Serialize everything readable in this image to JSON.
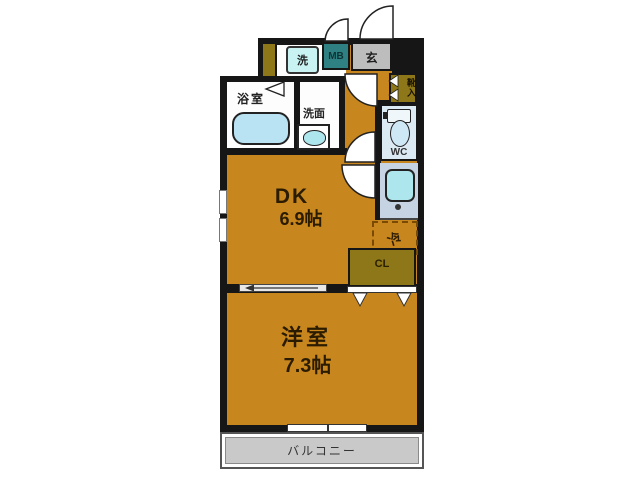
{
  "plan": {
    "title": "1DK floor plan",
    "rooms": {
      "dk": {
        "label": "DK",
        "size": "6.9帖"
      },
      "western": {
        "label": "洋室",
        "size": "7.3帖"
      },
      "balcony": {
        "label": "バルコニー"
      },
      "bathroom": {
        "label": "浴室"
      },
      "washroom": {
        "label": "洗面"
      },
      "wc": {
        "label": "WC"
      },
      "closet": {
        "label": "CL"
      },
      "shoe_box": {
        "label": "靴入"
      },
      "entrance": {
        "label": "玄"
      },
      "meter_box": {
        "label": "MB"
      },
      "laundry": {
        "label": "洗"
      },
      "refrigerator": {
        "label": "冷"
      }
    },
    "colors": {
      "floor": "#C8861E",
      "storage_olive": "#8E7718",
      "meter_box_teal": "#2F8082",
      "entrance_gray": "#BDBDBD",
      "balcony_gray": "#C9C9C9",
      "fixture_cyan": "#AEE6EE",
      "tub_blue": "#B9E3F2",
      "kitchen_counter": "#C5D3E2",
      "wall": "#161616"
    }
  }
}
